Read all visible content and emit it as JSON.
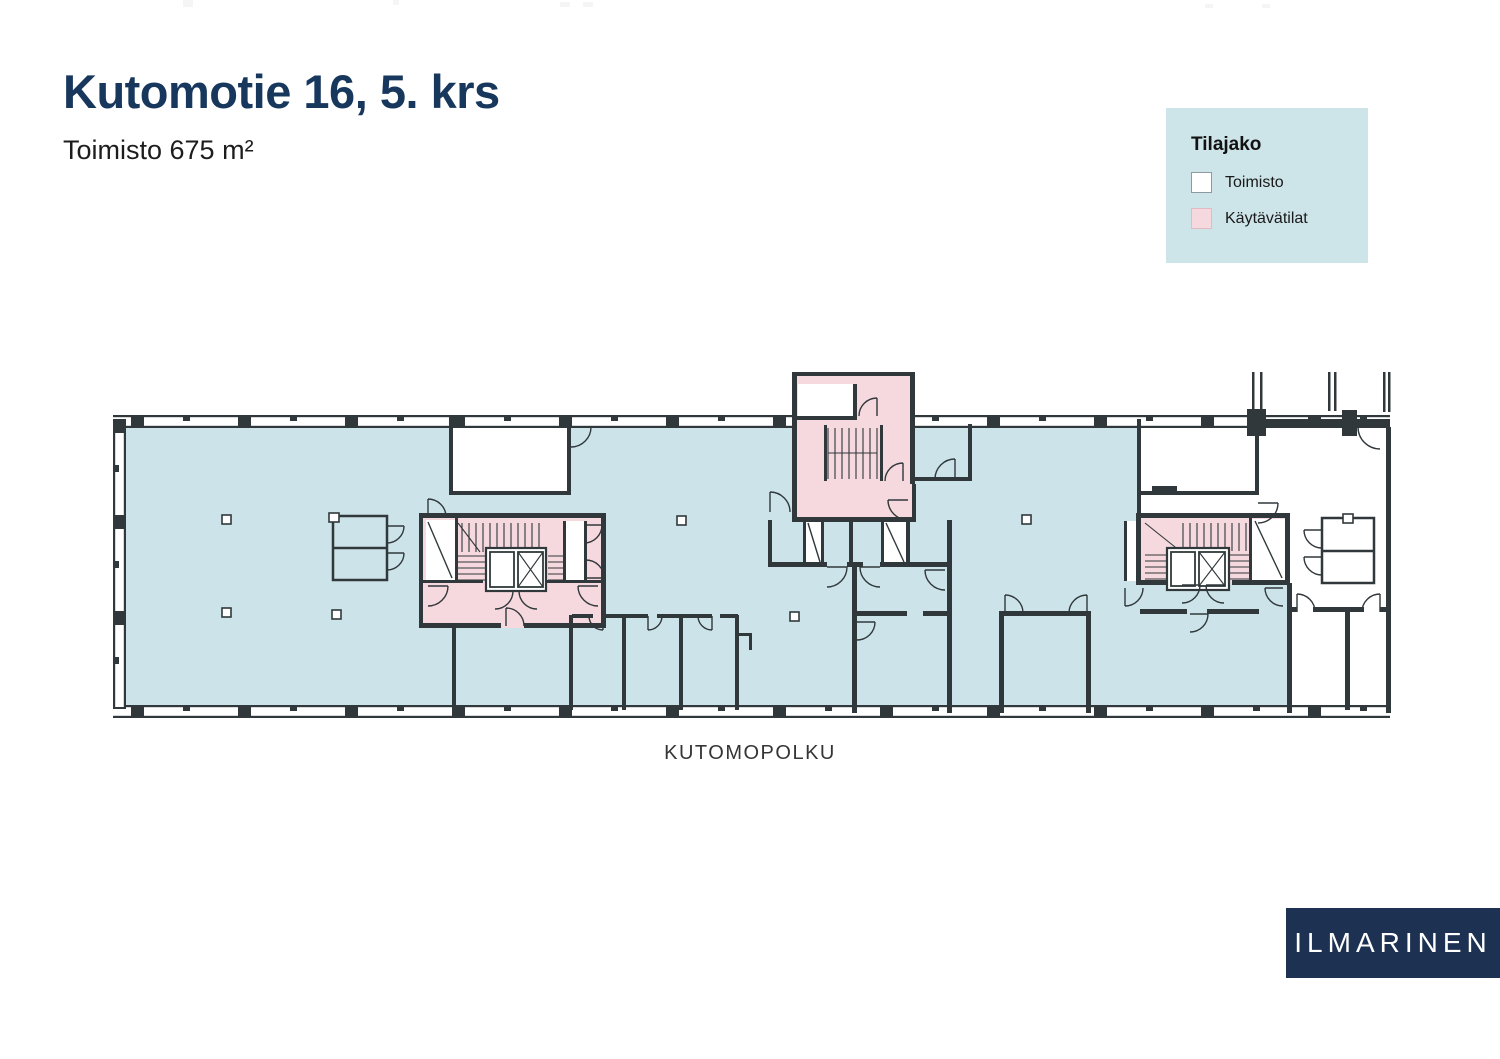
{
  "css_vars": {
    "--navy": "#17375d",
    "--office": "#cce4e9",
    "--corridor": "#f6d9de",
    "--wall": "#30383b",
    "--legend-bg": "#cde4e9",
    "--logo-bg": "#1d3152"
  },
  "header": {
    "title": "Kutomotie 16, 5. krs",
    "subtitle": "Toimisto 675 m²"
  },
  "legend": {
    "title": "Tilajako",
    "items": [
      {
        "label": "Toimisto",
        "color": "#ffffff"
      },
      {
        "label": "Käytävätilat",
        "color": "#f6d9de"
      }
    ]
  },
  "floor_plan": {
    "street_label": "KUTOMOPOLKU",
    "colors": {
      "office": "#cce4e9",
      "corridor": "#f6d9de",
      "walls": "#30383b"
    }
  },
  "logo": {
    "text": "ILMARINEN"
  }
}
